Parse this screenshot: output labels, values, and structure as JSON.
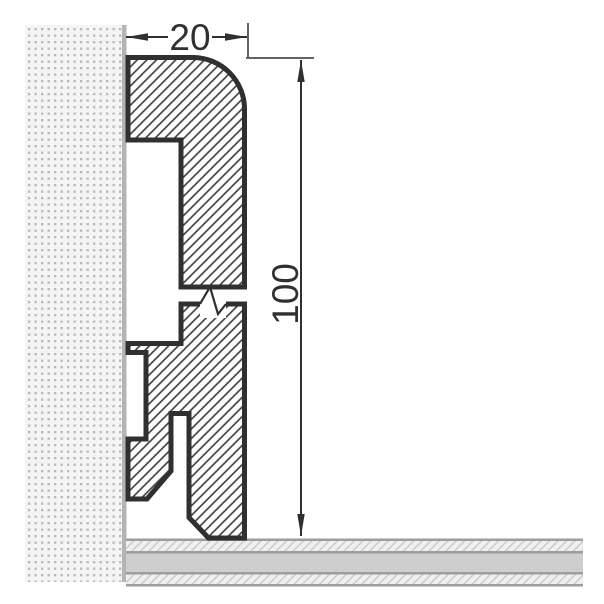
{
  "diagram": {
    "type": "skirting-board-profile-cross-section",
    "labels": {
      "width_dim": "20",
      "height_dim": "100"
    },
    "colors": {
      "outline": "#303030",
      "dimension": "#303030",
      "hatch_line": "#3a3a3a",
      "wall_fill": "#f4f4f4",
      "wall_dot": "#b9b9b9",
      "wall_edge": "#b4b4b4",
      "floor_border": "#9e9e9e",
      "floor_band": "#cecece",
      "floor_hatch_bg": "#f0f0f0",
      "floor_hatch_line": "#c8c8c8"
    }
  }
}
